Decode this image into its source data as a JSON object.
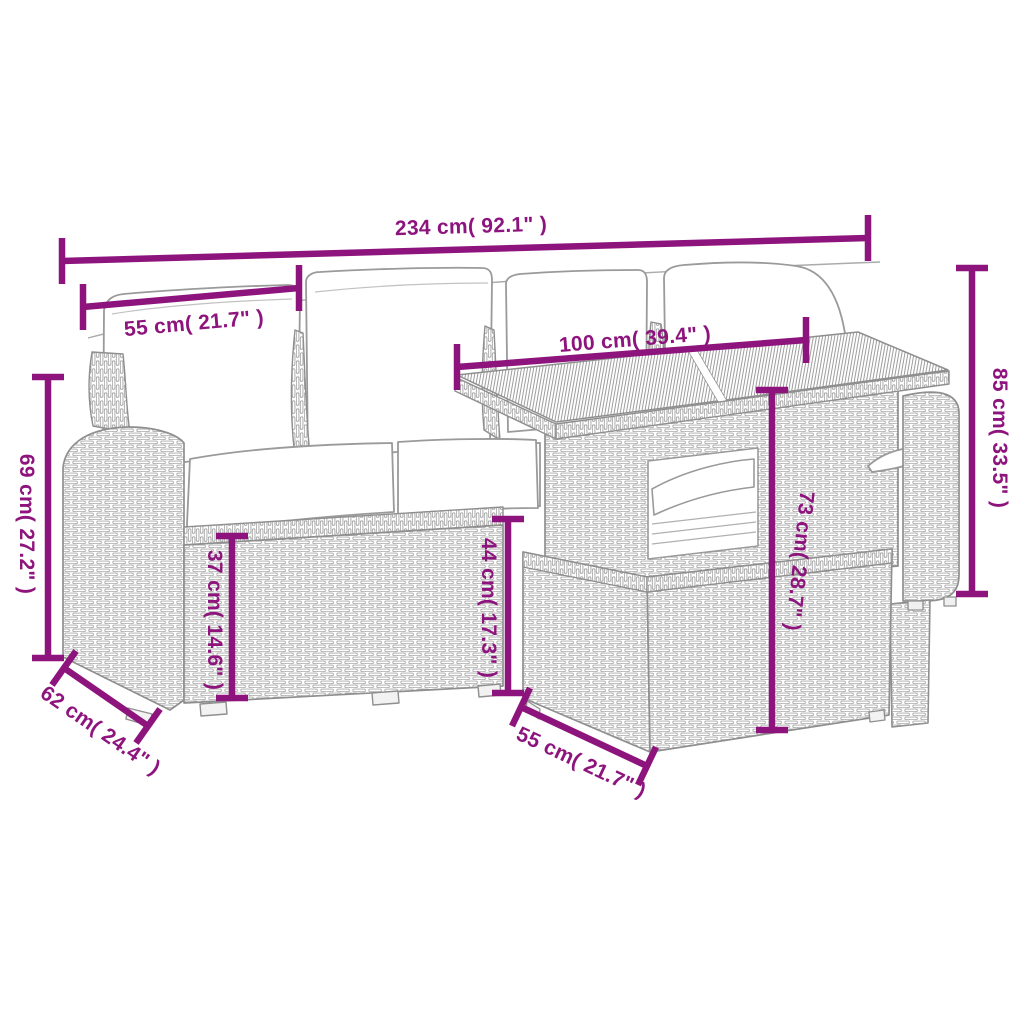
{
  "diagram": {
    "accent_color": "#8E147D",
    "line_art_color": "#8f8f8f",
    "dimensions": [
      {
        "id": "overall_width",
        "label": "234 cm( 92.1\" )"
      },
      {
        "id": "seat_width",
        "label": "55 cm( 21.7\" )"
      },
      {
        "id": "table_length",
        "label": "100 cm( 39.4\" )"
      },
      {
        "id": "table_height",
        "label": "85 cm( 33.5\" )"
      },
      {
        "id": "armrest_height",
        "label": "69 cm( 27.2\" )"
      },
      {
        "id": "base_height",
        "label": "37 cm( 14.6\" )"
      },
      {
        "id": "seat_height",
        "label": "44 cm( 17.3\" )"
      },
      {
        "id": "tabletop_height",
        "label": "73 cm( 28.7\" )"
      },
      {
        "id": "sofa_side_depth",
        "label": "62 cm( 24.4\" )"
      },
      {
        "id": "stool_side_depth",
        "label": "55 cm( 21.7\" )"
      }
    ]
  }
}
